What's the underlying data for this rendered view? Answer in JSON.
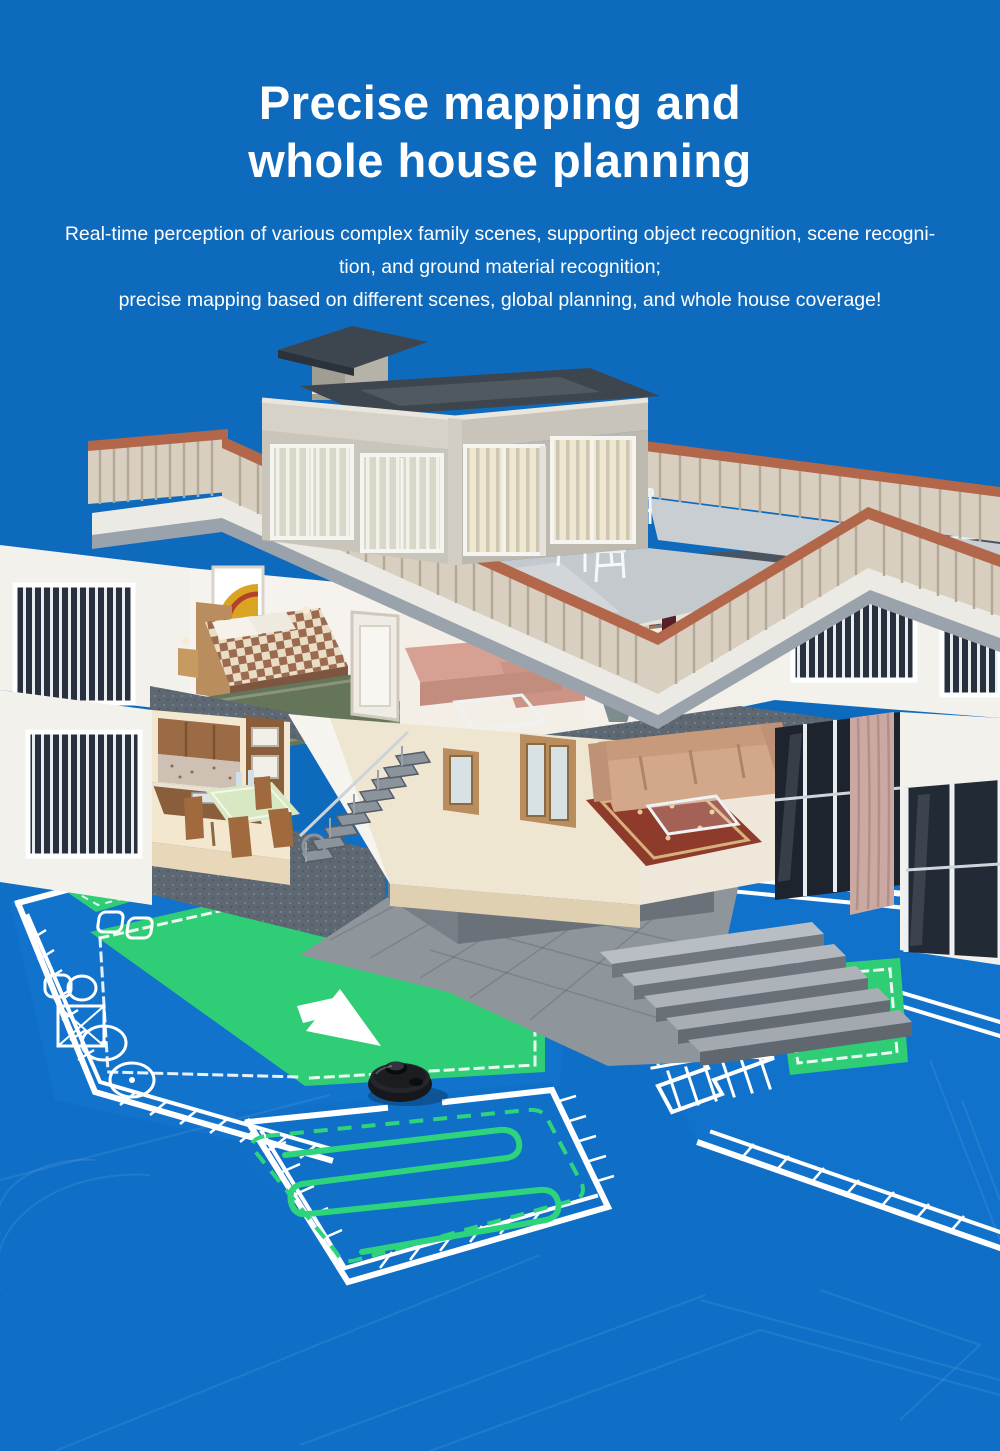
{
  "page": {
    "width": 1000,
    "height": 1451,
    "background": "#0d6abd"
  },
  "hero": {
    "title_line1": "Precise mapping and",
    "title_line2": "whole house planning",
    "subtitle_lines": [
      "Real-time perception of various complex family scenes, supporting object recognition, scene recogni-",
      "tion, and ground material recognition;",
      "precise mapping based on different scenes, global planning, and whole house coverage!"
    ],
    "text_color": "#ffffff"
  },
  "illustration": {
    "description": "3D cutaway house with rooftop terrace above a blueprint floor map cleaned by a robot vacuum",
    "colors": {
      "blueprint_blue": "#1173cc",
      "blueprint_blue_alt": "#0f6fc6",
      "map_line_white": "#ffffff",
      "cleaned_zone_green": "#2fcd75",
      "path_green": "#2ed47b",
      "stone_gray": "#8e959b",
      "slab_gray": "#5e6873",
      "wall_white": "#f3f1ec",
      "railing_tan": "#d8cfc0",
      "railing_cap_terracotta": "#b2664a",
      "roof_dark": "#3d464e",
      "wood": "#b98d5e",
      "robot_black": "#17181b"
    }
  }
}
